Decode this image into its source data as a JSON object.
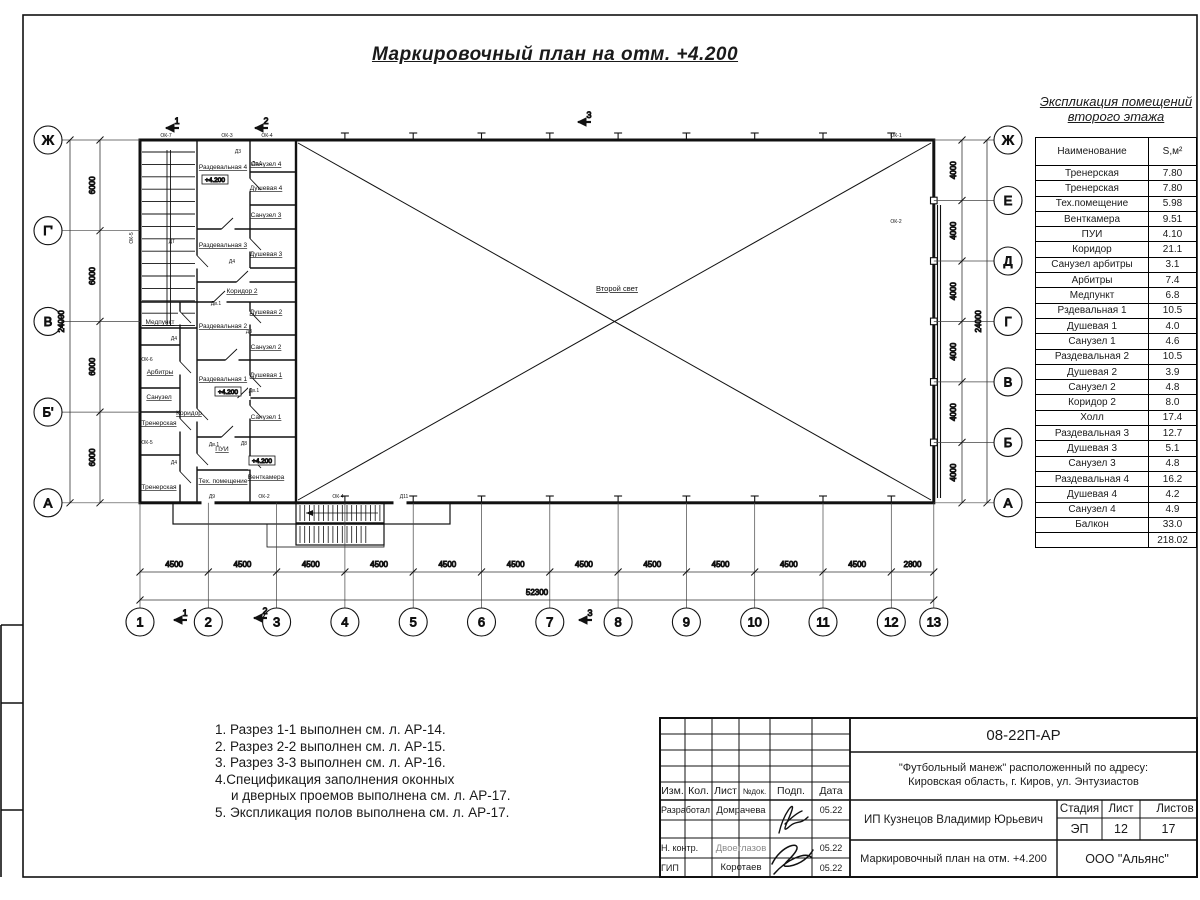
{
  "title": "Маркировочный план на отм. +4.200",
  "plan": {
    "hall_label": "Второй свет",
    "axes_left": [
      "Ж",
      "Г'",
      "В",
      "Б'",
      "А"
    ],
    "axes_right": [
      "Ж",
      "Е",
      "Д",
      "Г",
      "В",
      "Б",
      "А"
    ],
    "axes_bottom": [
      "1",
      "2",
      "3",
      "4",
      "5",
      "6",
      "7",
      "8",
      "9",
      "10",
      "11",
      "12",
      "13"
    ],
    "dims": {
      "left_segments": [
        "6000",
        "6000",
        "6000",
        "6000"
      ],
      "left_total": "24000",
      "right_segments": [
        "4000",
        "4000",
        "4000",
        "4000",
        "4000",
        "4000"
      ],
      "right_total": "24000",
      "bottom_segments": [
        "4500",
        "4500",
        "4500",
        "4500",
        "4500",
        "4500",
        "4500",
        "4500",
        "4500",
        "4500",
        "4500",
        "2800"
      ],
      "bottom_total": "52300"
    },
    "section_markers_top": [
      {
        "label": "1",
        "x": 168,
        "y": 116
      },
      {
        "label": "2",
        "x": 257,
        "y": 116
      },
      {
        "label": "3",
        "x": 580,
        "y": 110
      }
    ],
    "section_markers_bottom": [
      {
        "label": "1",
        "x": 176,
        "y": 608
      },
      {
        "label": "2",
        "x": 256,
        "y": 606
      },
      {
        "label": "3",
        "x": 581,
        "y": 608
      }
    ],
    "rooms": [
      {
        "label": "Раздевальная 4",
        "x": 223,
        "y": 169
      },
      {
        "label": "Санузел 4",
        "x": 266,
        "y": 166
      },
      {
        "label": "Душевая 4",
        "x": 266,
        "y": 190
      },
      {
        "label": "Санузел 3",
        "x": 266,
        "y": 217
      },
      {
        "label": "Раздевальная 3",
        "x": 223,
        "y": 247
      },
      {
        "label": "Душевая 3",
        "x": 266,
        "y": 256
      },
      {
        "label": "Коридор 2",
        "x": 242,
        "y": 293
      },
      {
        "label": "Медпункт",
        "x": 160,
        "y": 324
      },
      {
        "label": "Раздевальная 2",
        "x": 223,
        "y": 328
      },
      {
        "label": "Душевая 2",
        "x": 266,
        "y": 314
      },
      {
        "label": "Санузел 2",
        "x": 266,
        "y": 349
      },
      {
        "label": "Арбитры",
        "x": 160,
        "y": 374
      },
      {
        "label": "Раздевальная 1",
        "x": 223,
        "y": 381
      },
      {
        "label": "Душевая 1",
        "x": 266,
        "y": 377
      },
      {
        "label": "Санузел",
        "x": 159,
        "y": 399
      },
      {
        "label": "Коридор",
        "x": 189,
        "y": 415
      },
      {
        "label": "Санузел 1",
        "x": 266,
        "y": 419
      },
      {
        "label": "Тренерская",
        "x": 159,
        "y": 425
      },
      {
        "label": "ПУИ",
        "x": 222,
        "y": 451
      },
      {
        "label": "Венткамера",
        "x": 266,
        "y": 479
      },
      {
        "label": "Тех. помещение",
        "x": 223,
        "y": 483
      },
      {
        "label": "Тренерская",
        "x": 159,
        "y": 489
      }
    ],
    "level_marks": [
      {
        "text": "+4.200",
        "x": 215,
        "y": 182
      },
      {
        "text": "+4.200",
        "x": 228,
        "y": 394
      },
      {
        "text": "+4.200",
        "x": 262,
        "y": 463
      }
    ],
    "tags": [
      {
        "t": "ОК-7",
        "x": 166,
        "y": 137
      },
      {
        "t": "ОК-3",
        "x": 227,
        "y": 137
      },
      {
        "t": "ОК-4",
        "x": 267,
        "y": 137
      },
      {
        "t": "ОК-1",
        "x": 896,
        "y": 137
      },
      {
        "t": "ОК-2",
        "x": 896,
        "y": 223
      },
      {
        "t": "ОК-5",
        "x": 133,
        "y": 238,
        "r": -90
      },
      {
        "t": "ОК-6",
        "x": 147,
        "y": 361
      },
      {
        "t": "ОК-5",
        "x": 147,
        "y": 444
      },
      {
        "t": "Д9",
        "x": 212,
        "y": 498
      },
      {
        "t": "ОК-2",
        "x": 264,
        "y": 498
      },
      {
        "t": "ОК-4",
        "x": 338,
        "y": 498
      },
      {
        "t": "Д11",
        "x": 404,
        "y": 498
      },
      {
        "t": "ДТ",
        "x": 172,
        "y": 243
      },
      {
        "t": "Д3",
        "x": 238,
        "y": 153
      },
      {
        "t": "Дв.1",
        "x": 257,
        "y": 165
      },
      {
        "t": "Д4",
        "x": 232,
        "y": 263
      },
      {
        "t": "Дв.1",
        "x": 216,
        "y": 305
      },
      {
        "t": "Д3",
        "x": 249,
        "y": 333
      },
      {
        "t": "Дв.1",
        "x": 254,
        "y": 392
      },
      {
        "t": "Д8",
        "x": 244,
        "y": 445
      },
      {
        "t": "Дв.1",
        "x": 214,
        "y": 446
      },
      {
        "t": "Д4",
        "x": 174,
        "y": 340
      },
      {
        "t": "Д4",
        "x": 174,
        "y": 464
      }
    ]
  },
  "schedule": {
    "title_line1": "Экспликация помещений",
    "title_line2": "второго этажа",
    "col_name": "Наименование",
    "col_area": "S,м²",
    "rows": [
      [
        "Тренерская",
        "7.80"
      ],
      [
        "Тренерская",
        "7.80"
      ],
      [
        "Тех.помещение",
        "5.98"
      ],
      [
        "Венткамера",
        "9.51"
      ],
      [
        "ПУИ",
        "4.10"
      ],
      [
        "Коридор",
        "21.1"
      ],
      [
        "Санузел арбитры",
        "3.1"
      ],
      [
        "Арбитры",
        "7.4"
      ],
      [
        "Медпункт",
        "6.8"
      ],
      [
        "Рздевальная 1",
        "10.5"
      ],
      [
        "Душевая 1",
        "4.0"
      ],
      [
        "Санузел 1",
        "4.6"
      ],
      [
        "Раздевальная 2",
        "10.5"
      ],
      [
        "Душевая 2",
        "3.9"
      ],
      [
        "Санузел 2",
        "4.8"
      ],
      [
        "Коридор 2",
        "8.0"
      ],
      [
        "Холл",
        "17.4"
      ],
      [
        "Раздевальная 3",
        "12.7"
      ],
      [
        "Душевая 3",
        "5.1"
      ],
      [
        "Санузел 3",
        "4.8"
      ],
      [
        "Раздевальная 4",
        "16.2"
      ],
      [
        "Душевая 4",
        "4.2"
      ],
      [
        "Санузел 4",
        "4.9"
      ],
      [
        "Балкон",
        "33.0"
      ],
      [
        "",
        "218.02"
      ]
    ]
  },
  "notes": [
    {
      "text": "1. Разрез 1-1 выполнен см. л. АР-14.",
      "indent": false
    },
    {
      "text": "2. Разрез 2-2 выполнен см. л. АР-15.",
      "indent": false
    },
    {
      "text": "3. Разрез 3-3 выполнен см. л. АР-16.",
      "indent": false
    },
    {
      "text": "4.Спецификация заполнения оконных",
      "indent": false
    },
    {
      "text": "и дверных проемов выполнена см. л. АР-17.",
      "indent": true
    },
    {
      "text": "5. Экспликация полов выполнена см. л. АР-17.",
      "indent": false
    }
  ],
  "titleblock": {
    "code": "08-22П-АР",
    "object_line1": "\"Футбольный манеж\" расположенный по адресу:",
    "object_line2": "Кировская область, г. Киров, ул. Энтузиастов",
    "client": "ИП Кузнецов Владимир Юрьевич",
    "doc_title": "Маркировочный план на отм. +4.200",
    "company": "ООО \"Альянс\"",
    "stage_label": "Стадия",
    "sheet_label": "Лист",
    "sheets_label": "Листов",
    "stage": "ЭП",
    "sheet": "12",
    "sheets": "17",
    "cols": [
      "Изм.",
      "Кол.",
      "Лист",
      "№док.",
      "Подп.",
      "Дата"
    ],
    "rows": [
      {
        "role": "Разработал",
        "name": "Домрачева",
        "date": "05.22"
      },
      {
        "role": "Н. контр.",
        "name": "Двоеглазов",
        "date": "05.22"
      },
      {
        "role": "ГИП",
        "name": "Коротаев",
        "date": "05.22"
      },
      {
        "role": "ГИП-date2",
        "date2": "05.22"
      }
    ]
  }
}
